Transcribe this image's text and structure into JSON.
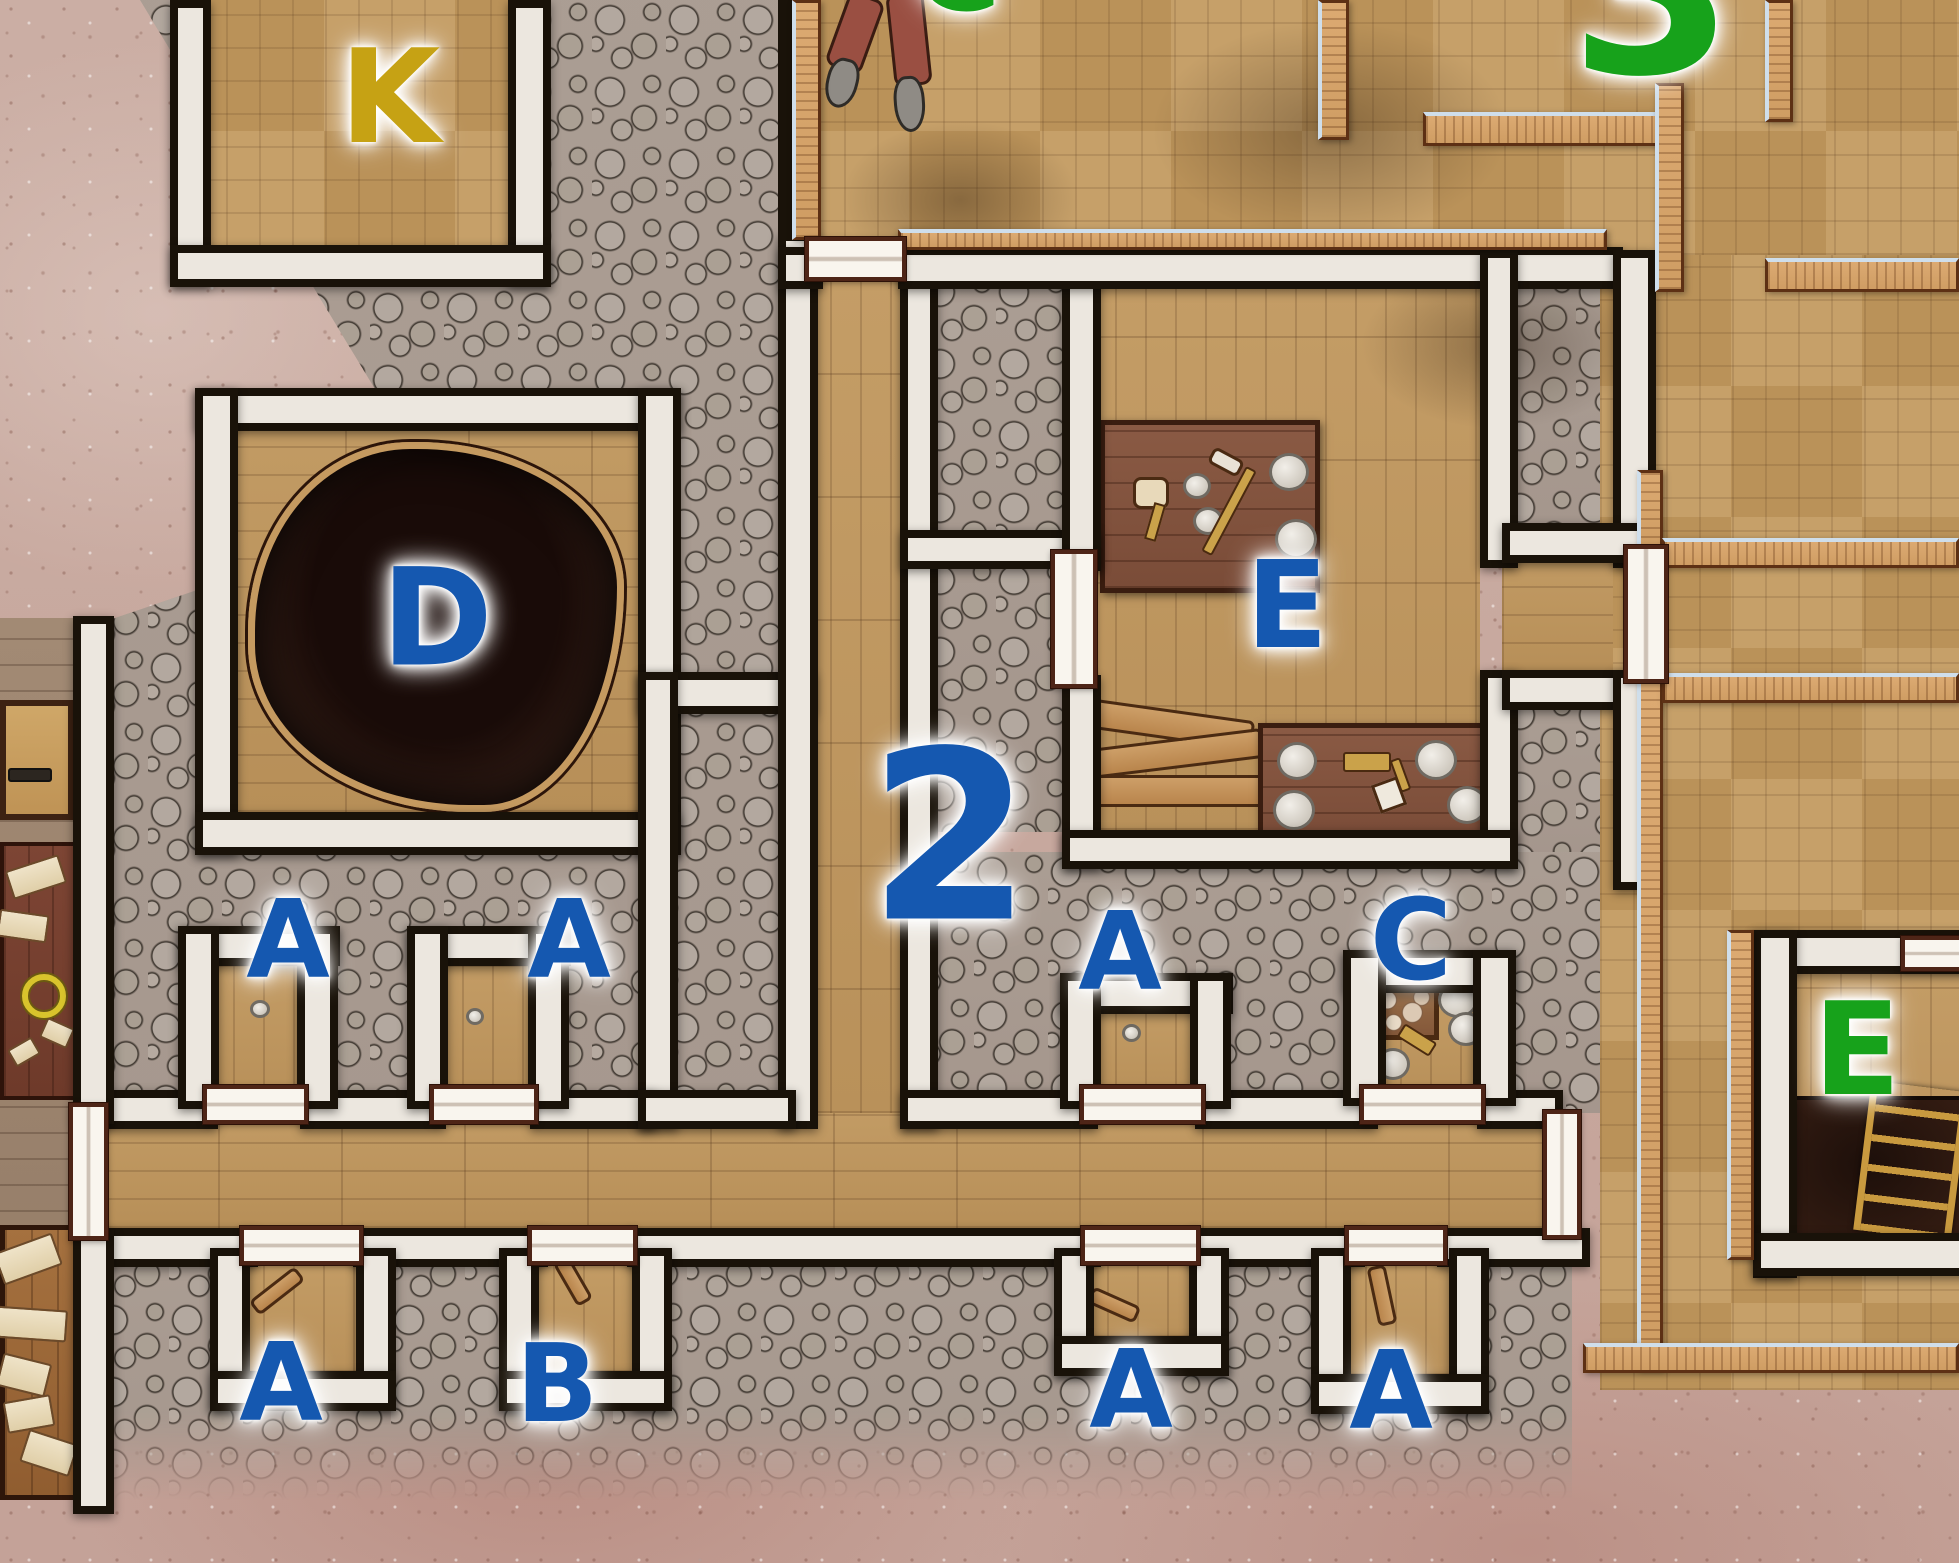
{
  "map": {
    "type": "tabletop-dungeon-battlemap",
    "width_px": 1959,
    "height_px": 1563,
    "palette": {
      "dirt": "#c9ada3",
      "stone": "#a89d93",
      "wood": "#c09a64",
      "wall_black": "#191209",
      "wall_trim_white": "#ece7df",
      "wall_wood_tan": "#d7a76f",
      "wall_trim_blue": "#cfdeeb",
      "door_white": "#f9f5ee",
      "door_frame": "#4e2517",
      "label_blue": "#1558b0",
      "label_green": "#17a21b",
      "label_gold": "#c6a214",
      "pit_brown": "#2e1a13"
    },
    "labels": [
      {
        "id": "room-K",
        "text": "K",
        "color": "#c6a214",
        "x": 390,
        "y": 97,
        "size": 130
      },
      {
        "id": "room-D",
        "text": "D",
        "color": "#1558b0",
        "x": 437,
        "y": 618,
        "size": 135
      },
      {
        "id": "room-E-center",
        "text": "E",
        "color": "#1558b0",
        "x": 1287,
        "y": 607,
        "size": 120
      },
      {
        "id": "area-2",
        "text": "2",
        "color": "#1558b0",
        "x": 950,
        "y": 838,
        "size": 235
      },
      {
        "id": "alcove-A-1",
        "text": "A",
        "color": "#1558b0",
        "x": 288,
        "y": 941,
        "size": 108
      },
      {
        "id": "alcove-A-2",
        "text": "A",
        "color": "#1558b0",
        "x": 569,
        "y": 941,
        "size": 108
      },
      {
        "id": "alcove-A-3",
        "text": "A",
        "color": "#1558b0",
        "x": 1120,
        "y": 953,
        "size": 108
      },
      {
        "id": "alcove-C",
        "text": "C",
        "color": "#1558b0",
        "x": 1411,
        "y": 941,
        "size": 112
      },
      {
        "id": "alcove-A-4",
        "text": "A",
        "color": "#1558b0",
        "x": 281,
        "y": 1384,
        "size": 108
      },
      {
        "id": "alcove-B",
        "text": "B",
        "color": "#1558b0",
        "x": 557,
        "y": 1385,
        "size": 108
      },
      {
        "id": "alcove-A-5",
        "text": "A",
        "color": "#1558b0",
        "x": 1131,
        "y": 1391,
        "size": 108
      },
      {
        "id": "alcove-A-6",
        "text": "A",
        "color": "#1558b0",
        "x": 1391,
        "y": 1392,
        "size": 108
      },
      {
        "id": "area-3",
        "text": "3",
        "color": "#17a21b",
        "x": 1652,
        "y": -8,
        "size": 235
      },
      {
        "id": "area-C-partial",
        "text": "C",
        "color": "#17a21b",
        "x": 957,
        "y": -30,
        "size": 120
      },
      {
        "id": "room-E-east",
        "text": "E",
        "color": "#17a21b",
        "x": 1857,
        "y": 1051,
        "size": 128
      }
    ],
    "features": {
      "pit": "burned-pit-room-D",
      "workbenches": 2,
      "plank-pile": "loose-boards-room-E",
      "crate": "supply-crate-alcove-C",
      "cellar-hatch": "dark-hatch-with-ladder-room-E-east",
      "figure": "fallen-figure-legs-top-corridor",
      "scroll-tables": "tables-with-papers-left-edge",
      "doors": 13
    }
  }
}
